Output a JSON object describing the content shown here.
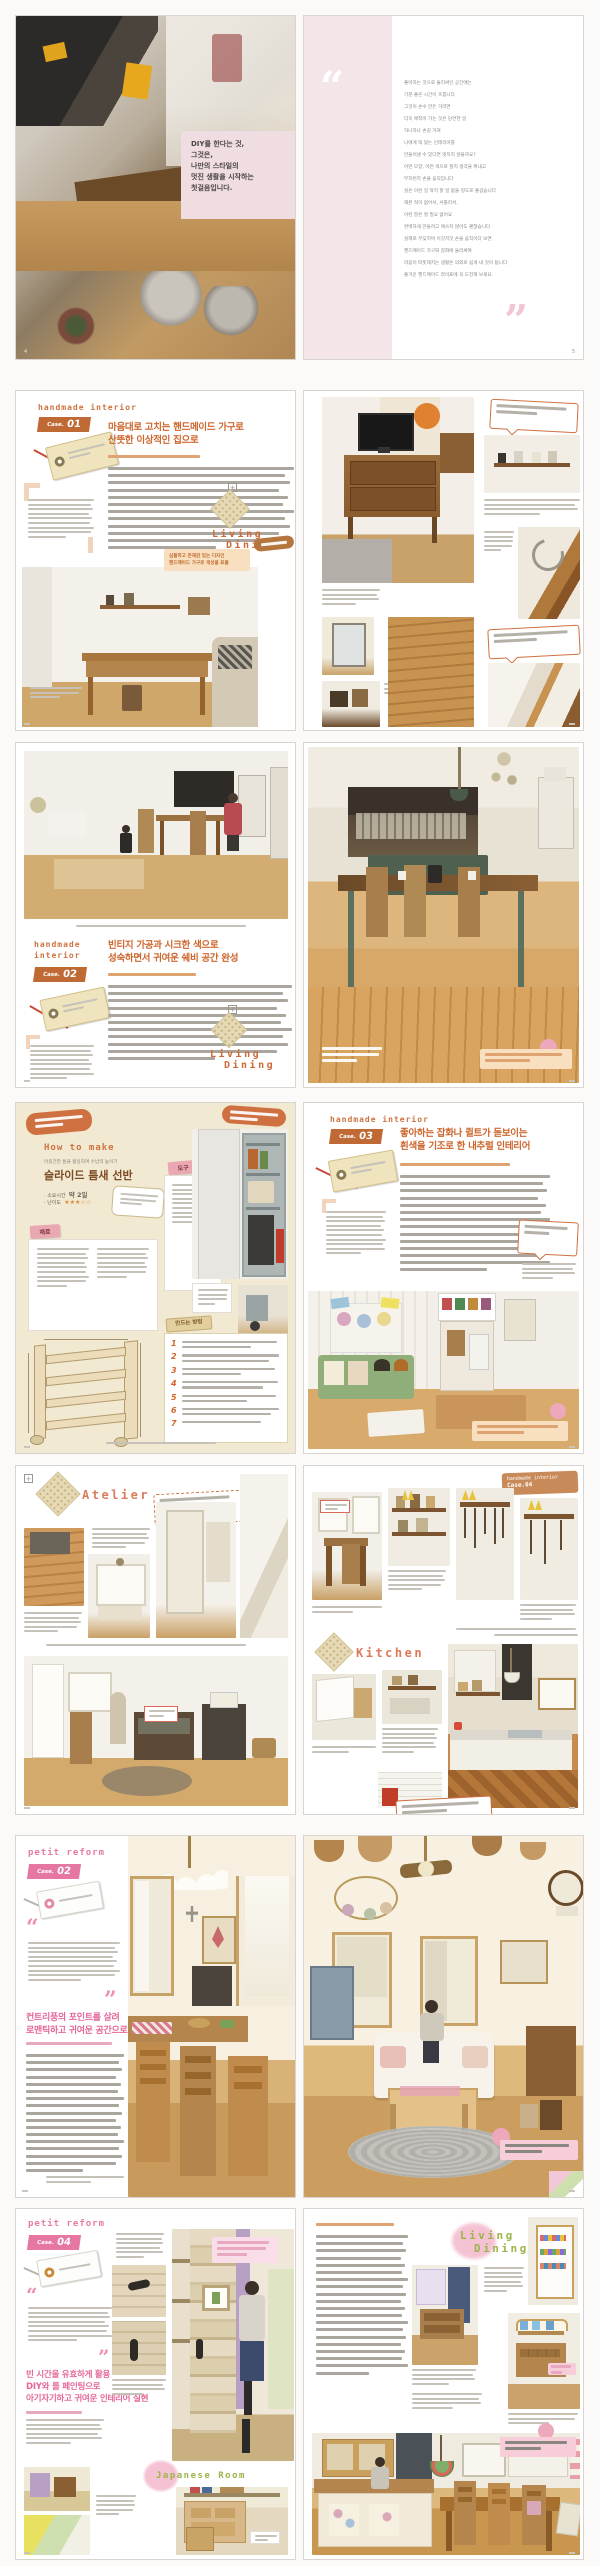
{
  "s1": {
    "left": {
      "overlay_lines": [
        "DIY를 한다는 것,",
        "그것은,",
        "나만의 스타일의",
        "멋진 생활을 시작하는",
        "첫걸음입니다."
      ],
      "page_num": "4"
    },
    "right": {
      "open_quote": "“",
      "close_quote": "”",
      "poem_lines": [
        "좋아하는 것으로 둘러싸인 공간에는",
        "기분 좋은 시간이 흐릅니다",
        "그것이 손수 만든 거라면",
        "더욱 애착이 가는 것은 당연한 일",
        "하나하나 손길 거쳐",
        "나에게 딱 맞는 인테리어를",
        "만들어낼 수 있다면 멋지지 않을까요?",
        "어떤 모양, 어떤 색으로 할지 생각을 짜내고",
        "부지런히 손을 움직입니다",
        "실은 이런 일 딱히 할 일 없을 정도로 즐겁습니다",
        "해본 적이 없어서, 서툴러서,",
        "이런 말은 할 필요 없어요",
        "완벽하게 만들려고 애쓰지 않아도 괜찮습니다",
        "실제로 부딪히며 이것저것 손을 움직이다 보면",
        "핸드메이드 가구와 잡화에 둘러싸여",
        "마음이 따뜻해지는 생활은 의외로 쉽게 내 것이 됩니다",
        "즐거운 핸드메이드 라이프에 꼭 도전해 보세요."
      ],
      "page_num": "5"
    }
  },
  "s2": {
    "header": "handmade interior",
    "case_label": "Case.",
    "case_num": "01",
    "title_lines": [
      "마음대로 고치는 핸드메이드 가구로",
      "산뜻한 이상적인 집으로"
    ],
    "stamp_lines": [
      "Living",
      "Dining"
    ],
    "callout_lines": [
      "심플하고 존재감 있는 디자인",
      "핸드메이드 가구로 개성을 표출"
    ]
  },
  "s3": {
    "header_lines": [
      "handmade",
      "interior"
    ],
    "case_label": "Case.",
    "case_num": "02",
    "title_lines": [
      "빈티지 가공과 시크한 색으로",
      "성숙하면서 귀여운 쉐비 공간 완성"
    ],
    "stamp_lines": [
      "Living",
      "Dining"
    ]
  },
  "s4": {
    "left": {
      "script": "How to make",
      "intro": "어중간한 틈을 활용하여 수납력 높이기",
      "title": "슬라이드 틈새 선반",
      "spec_time_label": "소요시간",
      "spec_time_value": "약 2일",
      "spec_level_label": "난이도",
      "stars": "★★★☆☆",
      "materials_label": "재료",
      "tools_label": "도구",
      "steps_label": "만드는 방법",
      "step_numbers": [
        "1",
        "2",
        "3",
        "4",
        "5",
        "6",
        "7"
      ]
    },
    "right": {
      "header": "handmade interior",
      "case_label": "Case.",
      "case_num": "03",
      "title_lines": [
        "좋아하는 잡화나 퀼트가 돋보이는",
        "흰색을 기조로 한 내추럴 인테리어"
      ]
    }
  },
  "s5": {
    "left": {
      "stamp": "Atelier"
    },
    "right": {
      "tab_line1": "handmade interior",
      "tab_line2": "Case.04",
      "stamp": "Kitchen"
    }
  },
  "s6": {
    "header": "petit reform",
    "case_label": "Case.",
    "case_num": "02",
    "open_quote": "“",
    "close_quote": "”",
    "title_lines": [
      "컨트리풍의 포인트를 살려",
      "로맨틱하고 귀여운 공간으로"
    ]
  },
  "s7": {
    "header": "petit reform",
    "case_label": "Case.",
    "case_num": "04",
    "open_quote": "“",
    "close_quote": "”",
    "title_lines": [
      "빈 시간을 유효하게 활용",
      "DIY와 롤 페인팅으로",
      "아기자기하고 귀여운 인테리어 실현"
    ],
    "stamp_japanese": "Japanese Room",
    "stamp_living_lines": [
      "Living",
      "Dining"
    ]
  }
}
